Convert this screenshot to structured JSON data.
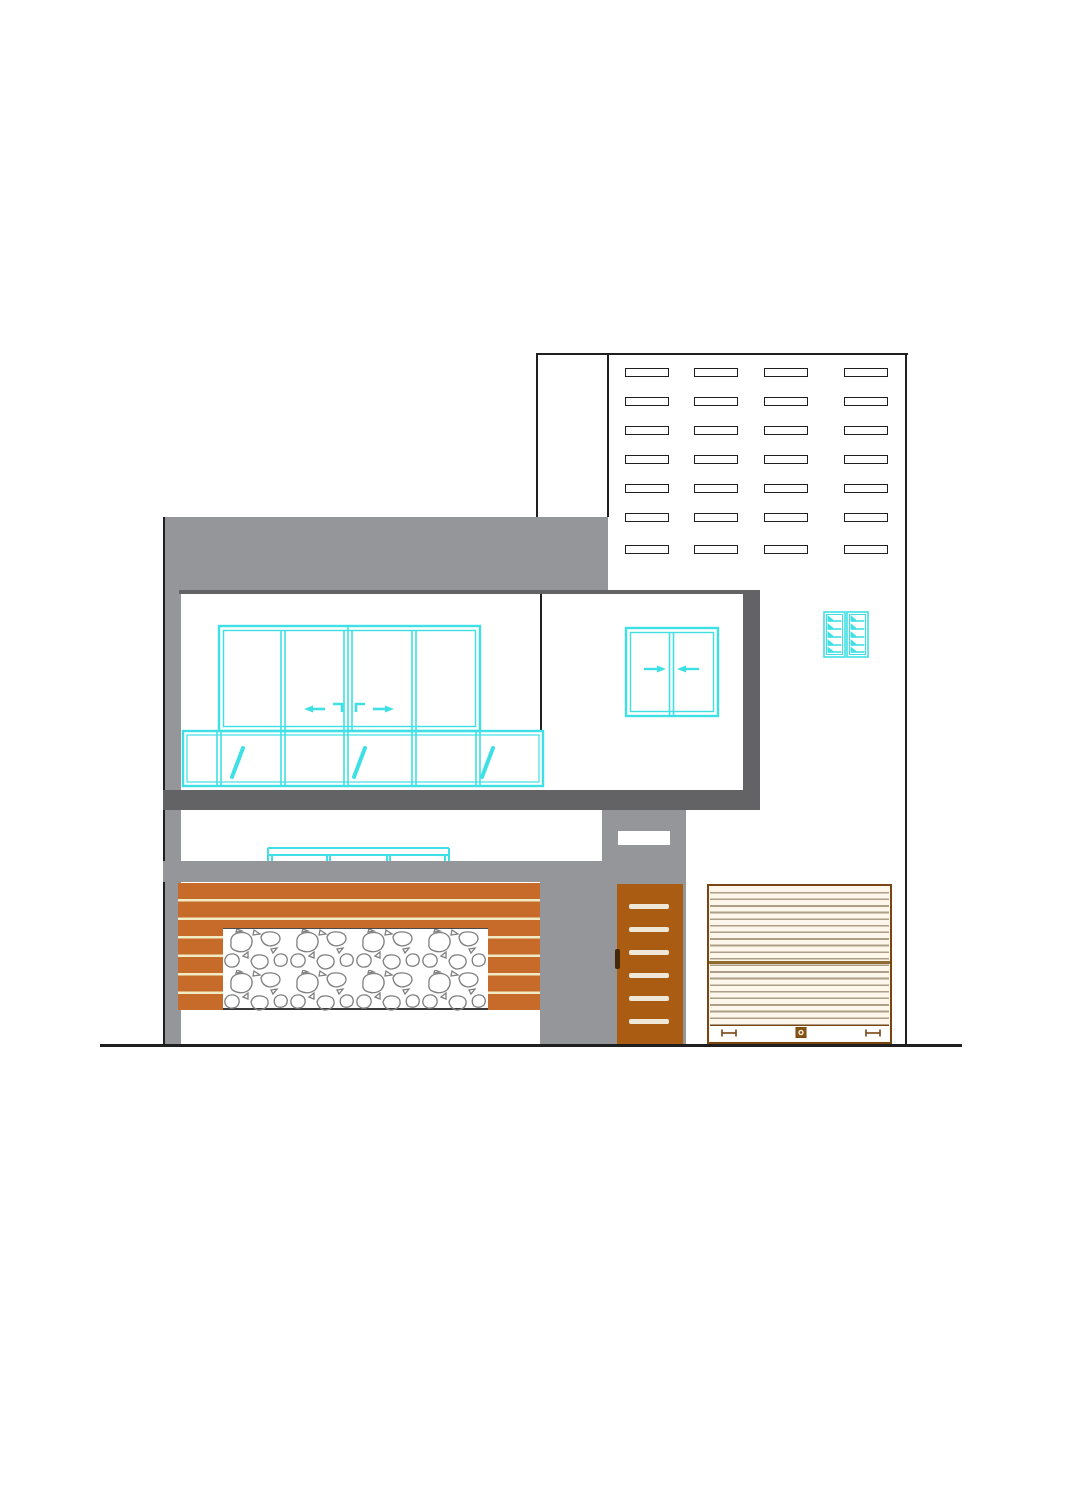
{
  "document": {
    "title": "house front elevation drawing",
    "visible_text": []
  },
  "colors": {
    "background": "#FFFFFF",
    "line_black": "#1F1F1F",
    "wall_gray": "#95969A",
    "band_dark": "#636366",
    "cyan": "#3FE0E5",
    "slat_orange": "#C76B2A",
    "slat_gap": "#F2ECC6",
    "door_brown": "#A95C12",
    "door_stripe": "#EFE8D8",
    "door_handle": "#45280A",
    "shutter_bg": "#FCF7EA",
    "shutter_line": "#AC9E87",
    "shutter_mid": "#8F6B2F",
    "shutter_border": "#7A4510",
    "stone_line": "#7F7F7F"
  },
  "facade": {
    "upper_louvers": {
      "columns": 4,
      "rows": 7
    },
    "parapet": {
      "kind": "gray band"
    },
    "main_window": {
      "upper_sliding_panels": 4,
      "lower_fixed_panels": 6,
      "glass_marks": 3,
      "arrow_directions": [
        "left",
        "right"
      ]
    },
    "secondary_window": {
      "sliding_panels": 2,
      "arrow_directions": [
        "right",
        "left"
      ]
    },
    "ventilator": {
      "cells": 2,
      "louvers_per_cell": 5
    },
    "clerestory_window": {
      "panels": 3
    },
    "slat_wall": {
      "gap_lines": 6
    },
    "stone_panel": {
      "texture": "random rubble"
    },
    "entry_door": {
      "stripes": 6,
      "handle": true
    },
    "rolling_shutter": {
      "bottom_fittings": [
        "handle",
        "lock",
        "handle"
      ]
    }
  }
}
